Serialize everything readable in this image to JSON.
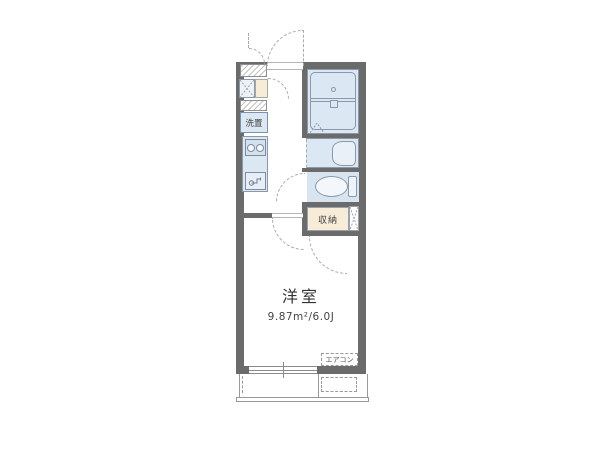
{
  "plan": {
    "labels": {
      "room": "洋室",
      "room_size": "9.87m²/6.0J",
      "storage": "収納",
      "washer": "洗置",
      "aircon": "エアコン"
    }
  },
  "colors": {
    "wall": "#6b6b6b",
    "fixture_fill": "#dce7f4",
    "fixture_fill_light": "#e9f0f8",
    "fixture_border": "#8b98a9",
    "accent_beige": "#f6ecd8",
    "line_gray": "#999999",
    "dash_gray": "#aaaaaa",
    "text": "#3c3c3c"
  },
  "icons": {
    "bathtub": "rounded-rect-with-divider-and-drain",
    "toilet": "ellipse-bowl-with-tank",
    "stove": "two-burner-circles",
    "sink": "faucet-glyph",
    "door_swing": "dashed-quarter-arc",
    "shaft": "x-cross-box",
    "folding_door": "dashed-triangle"
  }
}
